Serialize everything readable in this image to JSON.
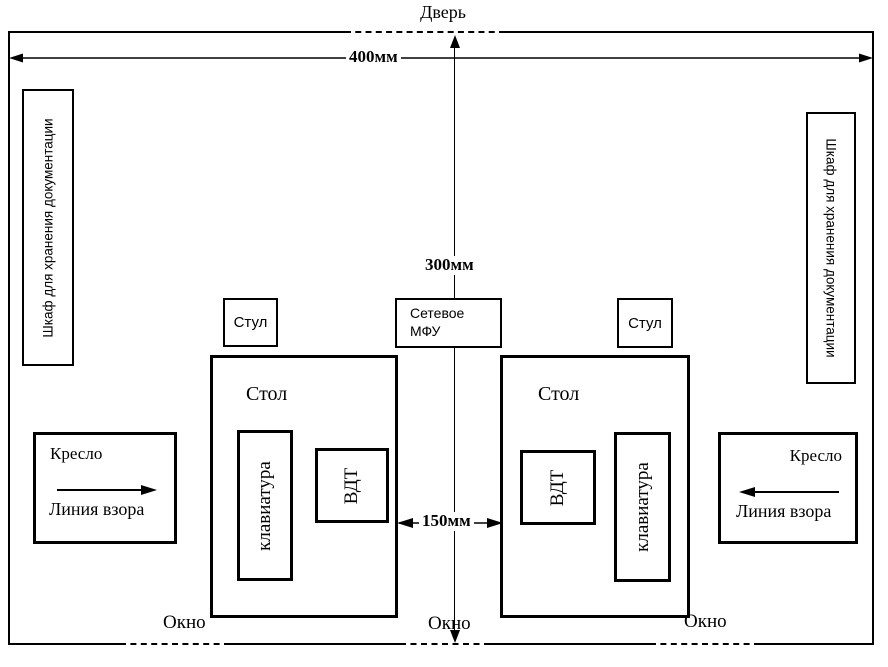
{
  "room": {
    "door": "Дверь",
    "dimensions": {
      "width": "400мм",
      "center": "300мм",
      "desk_gap": "150мм"
    },
    "cabinets": {
      "left": "Шкаф для хранения документации",
      "right": "Шкаф для хранения документации"
    },
    "chairs": {
      "left": "Стул",
      "right": "Стул"
    },
    "printer": {
      "label": "Сетевое МФУ"
    },
    "desks": {
      "left": {
        "label": "Стол",
        "keyboard": "клавиатура",
        "display": "ВДТ"
      },
      "right": {
        "label": "Стол",
        "keyboard": "клавиатура",
        "display": "ВДТ"
      }
    },
    "armchairs": {
      "left": {
        "label": "Кресло",
        "sight_line": "Линия взора"
      },
      "right": {
        "label": "Кресло",
        "sight_line": "Линия взора"
      }
    },
    "windows": {
      "left": "Окно",
      "center": "Окно",
      "right": "Окно"
    },
    "colors": {
      "line": "#000000",
      "background": "#ffffff"
    }
  }
}
